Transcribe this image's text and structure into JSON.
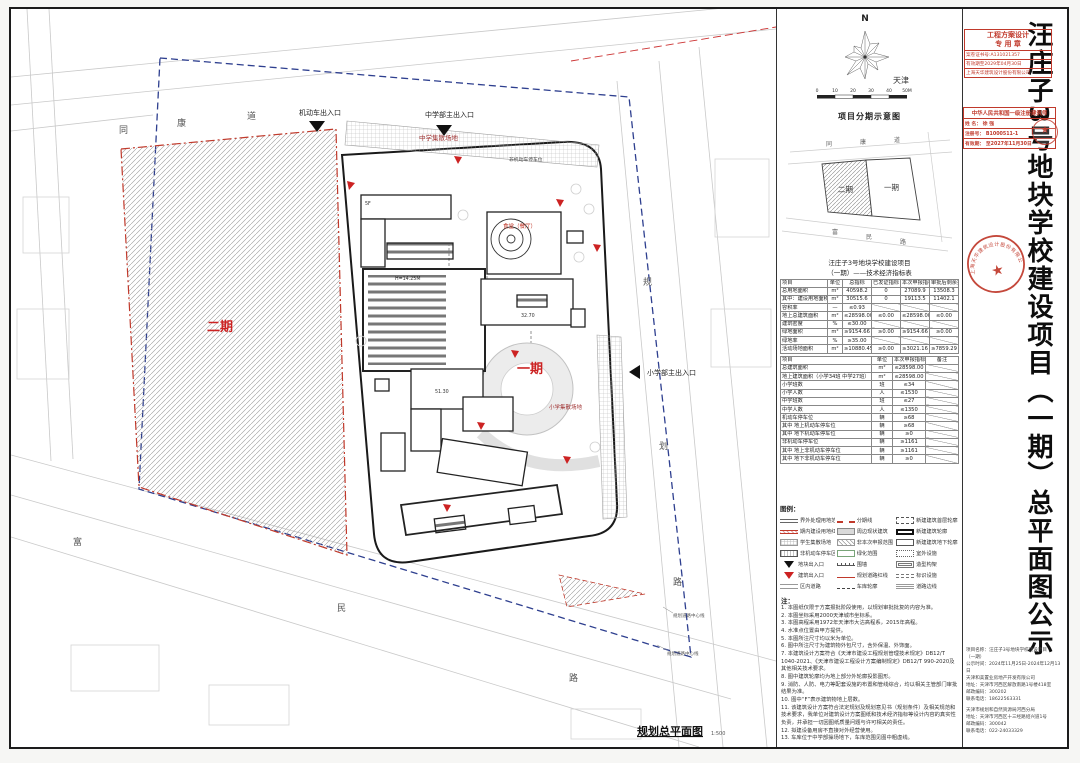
{
  "title": {
    "vertical_text": "汪庄子3号地块学校建设项目（一期）总平面图公示"
  },
  "accent_colors": {
    "boundary_red": "#c0392b",
    "boundary_blue": "#2e3f8f",
    "phase_label_red": "#cc2222"
  },
  "stamps": {
    "design_seal": {
      "title1": "工程方案设计",
      "title2": "专 用 章",
      "row1": "案卷证书号:A131021357",
      "row2": "有效期至2029年04月30日",
      "row3": "上海天华建筑设计股份有限公司"
    },
    "architect_seal": {
      "header": "中华人民共和国一级注册建筑师",
      "name": "姓 名： 徐  强",
      "reg": "注册号： B1000511-1",
      "valid": "有效期： 至2027年11月30日",
      "mini_seal_star": "★"
    },
    "round_seal": {
      "company": "上海天华建筑设计股份有限公司",
      "star": "★"
    }
  },
  "compass": {
    "north_label": "N",
    "city_label": "天津"
  },
  "scalebar": {
    "ticks": [
      "0",
      "10",
      "20",
      "30",
      "40",
      "50M"
    ]
  },
  "phasing": {
    "title": "项目分期示意图",
    "phase1_label": "一期",
    "phase2_label": "二期",
    "road_top": [
      "同",
      "康",
      "道"
    ],
    "road_bottom": [
      "富",
      "民",
      "路"
    ]
  },
  "table": {
    "title1": "汪庄子3号地块学校建设项目",
    "title2": "（一期）——技术经济指标表",
    "t1_headers": [
      "项目",
      "单位",
      "总指标",
      "已发证指标",
      "本次申报指标",
      "审批后剩余指标"
    ],
    "t1_rows": [
      [
        "总用地面积",
        "m²",
        "40598.2",
        "0",
        "27089.9",
        "13508.3"
      ],
      [
        "其中：建设用地面积",
        "m²",
        "30515.6",
        "0",
        "19113.5",
        "11402.1"
      ],
      [
        "容积率",
        "—",
        "≤0.93",
        "",
        "",
        ""
      ],
      [
        "地上总建筑面积",
        "m²",
        "≤28598.00",
        "≤0.00",
        "≤28598.00",
        "≤0.00"
      ],
      [
        "建筑密度",
        "%",
        "≤30.00",
        "",
        "",
        ""
      ],
      [
        "绿地面积",
        "m²",
        "≥9154.66",
        "≥0.00",
        "≥9154.66",
        "≥0.00"
      ],
      [
        "绿地率",
        "%",
        "≥35.00",
        "",
        "",
        ""
      ],
      [
        "活动场地面积",
        "m²",
        "≥10880.45",
        "≥0.00",
        "≥3021.16",
        "≥7859.29"
      ]
    ],
    "t2_headers": [
      "项目",
      "单位",
      "本次申报指标",
      "备注"
    ],
    "t2_rows": [
      [
        "总建筑面积",
        "m²",
        "≤28598.00",
        ""
      ],
      [
        "地上建筑面积（小学34班 中学27班）",
        "m²",
        "≤28598.00",
        ""
      ],
      [
        "小学班数",
        "班",
        "≤34",
        ""
      ],
      [
        "小学人数",
        "人",
        "≤1530",
        ""
      ],
      [
        "中学班数",
        "班",
        "≤27",
        ""
      ],
      [
        "中学人数",
        "人",
        "≤1350",
        ""
      ],
      [
        "机动车停车位",
        "辆",
        "≥68",
        ""
      ],
      [
        "其中 地上机动车停车位",
        "辆",
        "≥68",
        ""
      ],
      [
        "其中 地下机动车停车位",
        "辆",
        "≥0",
        ""
      ],
      [
        "非机动车停车位",
        "辆",
        "≥1161",
        ""
      ],
      [
        "其中 地上非机动车停车位",
        "辆",
        "≥1161",
        ""
      ],
      [
        "其中 地下非机动车停车位",
        "辆",
        "≥0",
        ""
      ]
    ]
  },
  "legend": {
    "title": "图例：",
    "items": [
      {
        "sym": "s-dbl",
        "label": "界外处理用地范围"
      },
      {
        "sym": "s-reddash",
        "label": "分期线"
      },
      {
        "sym": "s-dashbox",
        "label": "新建建筑首层轮廓"
      },
      {
        "sym": "s-redline2",
        "label": "期内建设用地红线"
      },
      {
        "sym": "s-gray",
        "label": "周边现状建筑"
      },
      {
        "sym": "s-bold",
        "label": "新建建筑轮廓"
      },
      {
        "sym": "s-cross",
        "label": "学生集散场地"
      },
      {
        "sym": "s-diag",
        "label": "非本次申报范围"
      },
      {
        "sym": "s-thin",
        "label": "新建建筑地下轮廓"
      },
      {
        "sym": "s-park",
        "label": "非机动车停车区"
      },
      {
        "sym": "s-green",
        "label": "绿化范围"
      },
      {
        "sym": "s-dot",
        "label": "室外设施"
      },
      {
        "sym": "s-btri",
        "label": "地块出入口"
      },
      {
        "sym": "s-wall",
        "label": "围墙"
      },
      {
        "sym": "s-dblbox",
        "label": "造型构架"
      },
      {
        "sym": "s-rtri",
        "label": "建筑出入口"
      },
      {
        "sym": "s-redsolid",
        "label": "规划道路红线"
      },
      {
        "sym": "s-eq",
        "label": "标识设施"
      },
      {
        "sym": "s-road",
        "label": "区内道路"
      },
      {
        "sym": "s-cdash",
        "label": "车库轮廓"
      },
      {
        "sym": "s-tri3",
        "label": "道路边线"
      }
    ]
  },
  "notes": {
    "title": "注：",
    "items": [
      "1. 本图纸仅限于方案报批阶段使用，以规划审批批复的内容为准。",
      "2. 本图坐标采用2000天津城市坐标系。",
      "3. 本图高程采用1972年天津市大沽高程系，2015年高程。",
      "4. 水准点位置由甲方提供。",
      "5. 本图所注尺寸均以米为单位。",
      "6. 图中所注尺寸为建筑物外包尺寸，含外保温、外饰面。",
      "7. 本建筑设计方案符合《天津市建设工程规划管理技术规定》DB12/T 1040-2021、《天津市建设工程设计方案编制规定》DB12/T 990-2020及其他相关技术要求。",
      "8. 图中建筑轮廓均为地上部分外轮廓投影图形。",
      "9. 消防、人防、电力等配套设施的布置和管线综合，均以相关主管部门审批结果为准。",
      "10. 图中“F”表示建筑物地上层数。",
      "11. 该建筑设计方案符合法定规划及规划意见书（规划条件）及相关规范和技术要求，我单位对建筑设计方案图纸和技术经济指标等设计内容的真实性负责，并承担一切因图纸质量问题与许可相关的责任。",
      "12. 拟建设备用房不直接对外经营使用。",
      "13. 车库位于中学部操场地下，车库范围见图中粗虚线。"
    ]
  },
  "plan": {
    "entrance_motor": "机动车出入口",
    "entrance_middle": "中学部主出入口",
    "entrance_primary": "小学部主出入口",
    "gather_middle": "中学集散场地",
    "gather_primary": "小学集散场地",
    "canteen": "食堂（餐厅）",
    "bike_parking": "非机动车停车位",
    "phase1": "一期",
    "phase2": "二期",
    "road_top": [
      "同",
      "康",
      "道"
    ],
    "road_right": [
      "规",
      "划",
      "路"
    ],
    "road_bottom": [
      "富",
      "民",
      "路"
    ],
    "dim1": "H=14.25M",
    "dim2": "32.70",
    "dim3": "51.30",
    "dim4": "5F",
    "caption": "规划总平面图",
    "caption_scale": "1:500",
    "leader1": "规划道路中心线",
    "leader2": "规划道路中心线"
  },
  "footer_info": {
    "block1": [
      "项目名称：汪庄子3号地块学校建设项目",
      "（一期）",
      "公示时间：2024年11月25日-2024年12月13日",
      "天津和美置业房地产开发有限公司",
      "地址：天津市河西区解放南路1号楼418室",
      "邮政编码：300202",
      "联系电话：18622563331"
    ],
    "block2": [
      "天津市规划和自然资源局河西分局",
      "地址：天津市河西区十三经路绍兴道1号",
      "邮政编码：300042",
      "联系电话：022-24033329"
    ]
  }
}
